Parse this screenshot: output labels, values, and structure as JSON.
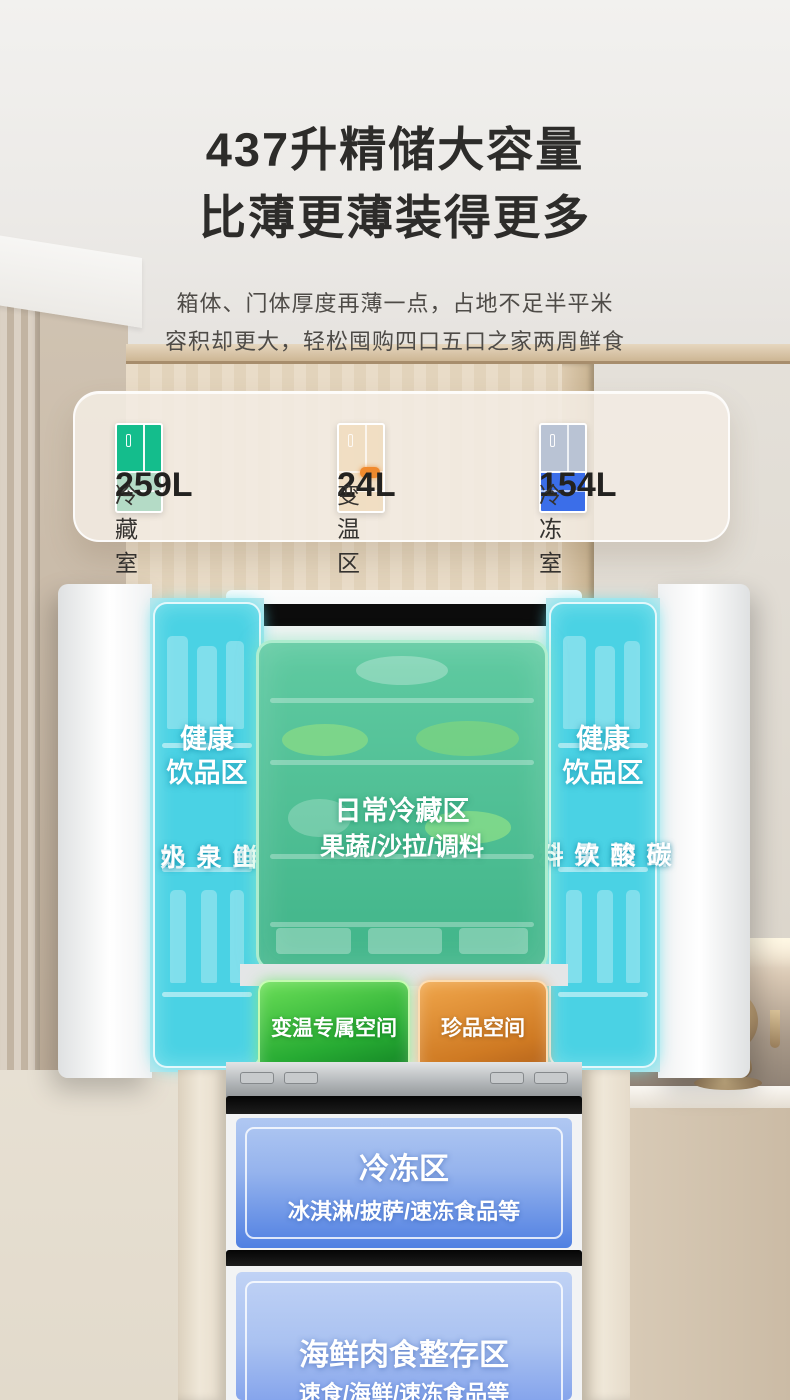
{
  "header": {
    "title_line1": "437升精储大容量",
    "title_line2": "比薄更薄装得更多",
    "desc_line1": "箱体、门体厚度再薄一点，占地不足半平米",
    "desc_line2": "容积却更大，轻松囤购四口五口之家两周鲜食"
  },
  "capacity_card": {
    "items": [
      {
        "value": "259L",
        "label": "冷藏室",
        "icon": "fridge-fresh-zone-icon",
        "accent": "#14bd8c"
      },
      {
        "value": "24L",
        "label": "变温区",
        "icon": "fridge-variable-zone-icon",
        "accent": "#f08a2e"
      },
      {
        "value": "154L",
        "label": "冷冻室",
        "icon": "fridge-freezer-zone-icon",
        "accent": "#3b6ee9"
      }
    ]
  },
  "fridge": {
    "left_door": {
      "title_line1": "健康",
      "title_line2": "饮品区",
      "col_left": "鲜牛奶",
      "col_right": "山泉水"
    },
    "right_door": {
      "title_line1": "健康",
      "title_line2": "饮品区",
      "col_left": "鲜榨果汁",
      "col_right": "碳酸饮料"
    },
    "main_zone": {
      "title": "日常冷藏区",
      "subtitle": "果蔬/沙拉/调料"
    },
    "variable_drawer": {
      "label": "变温专属空间"
    },
    "premium_drawer": {
      "label": "珍品空间"
    },
    "freezer_drawer": {
      "title": "冷冻区",
      "subtitle": "冰淇淋/披萨/速冻食品等"
    },
    "seafood_drawer": {
      "title": "海鲜肉食整存区",
      "subtitle": "速食/海鲜/速冻食品等"
    }
  },
  "colors": {
    "door_overlay": "#3acfe2",
    "main_overlay": "#44be92",
    "variable_box": "#2db93a",
    "premium_box": "#dd8836",
    "freezer_box": "#5583e4",
    "seafood_box": "#93aff0",
    "title_text": "#2d2c2a"
  }
}
